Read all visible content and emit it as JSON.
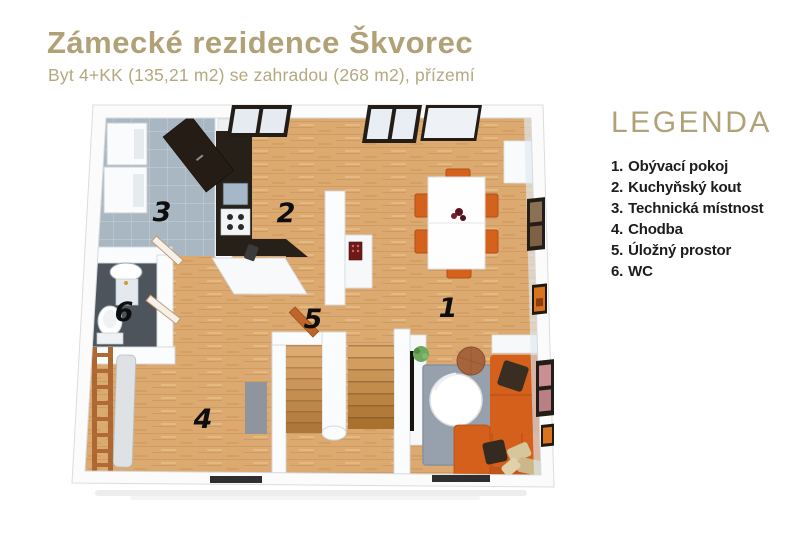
{
  "header": {
    "title": "Zámecké rezidence Škvorec",
    "subtitle": "Byt 4+KK (135,21 m2) se zahradou (268 m2), přízemí"
  },
  "legend": {
    "title": "LEGENDA",
    "items": [
      {
        "number": "1.",
        "label": "Obývací pokoj"
      },
      {
        "number": "2.",
        "label": "Kuchyňský kout"
      },
      {
        "number": "3.",
        "label": "Technická místnost"
      },
      {
        "number": "4.",
        "label": "Chodba"
      },
      {
        "number": "5.",
        "label": "Úložný prostor"
      },
      {
        "number": "6.",
        "label": "WC"
      }
    ]
  },
  "plan": {
    "rooms": {
      "r1": "1",
      "r2": "2",
      "r3": "3",
      "r4": "4",
      "r5": "5",
      "r6": "6"
    }
  },
  "colors": {
    "accent_gold": "#b1a176",
    "floor_wood": "#dcaa70",
    "floor_tile": "#a9b7c3",
    "floor_wc": "#4d545b",
    "kitchen_counter": "#272019",
    "furniture_orange": "#d4601c",
    "rug_gray": "#97a1ae",
    "wall_white": "#fbfcfd"
  }
}
